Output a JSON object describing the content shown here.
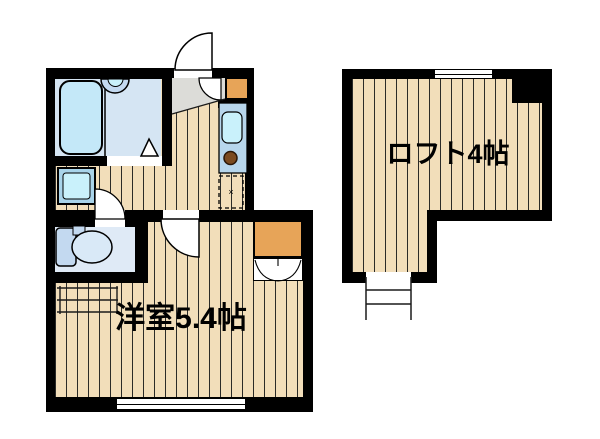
{
  "floorplan": {
    "labels": {
      "main_room": "洋室5.4帖",
      "loft": "ロフト4帖",
      "fridge_mark": "×"
    },
    "colors": {
      "wall": "#000000",
      "background": "#ffffff",
      "wood": "#f2deba",
      "plank_line": "#2b2b28",
      "bathroom": "#d5e5f3",
      "bathtub": "#c4e8f8",
      "toilet_room": "#dfeaf6",
      "fixture": "#c3d9f0",
      "fixture_light": "#d9e9f7",
      "counter": "#b7d6ec",
      "sink": "#c9f1fb",
      "pan_outer": "#a9d4ea",
      "pan_inner": "#c9f1fb",
      "burner": "#7b4a1f",
      "cabinet_orange": "#e7a458",
      "genkan_grey": "#dcdcd8"
    }
  }
}
